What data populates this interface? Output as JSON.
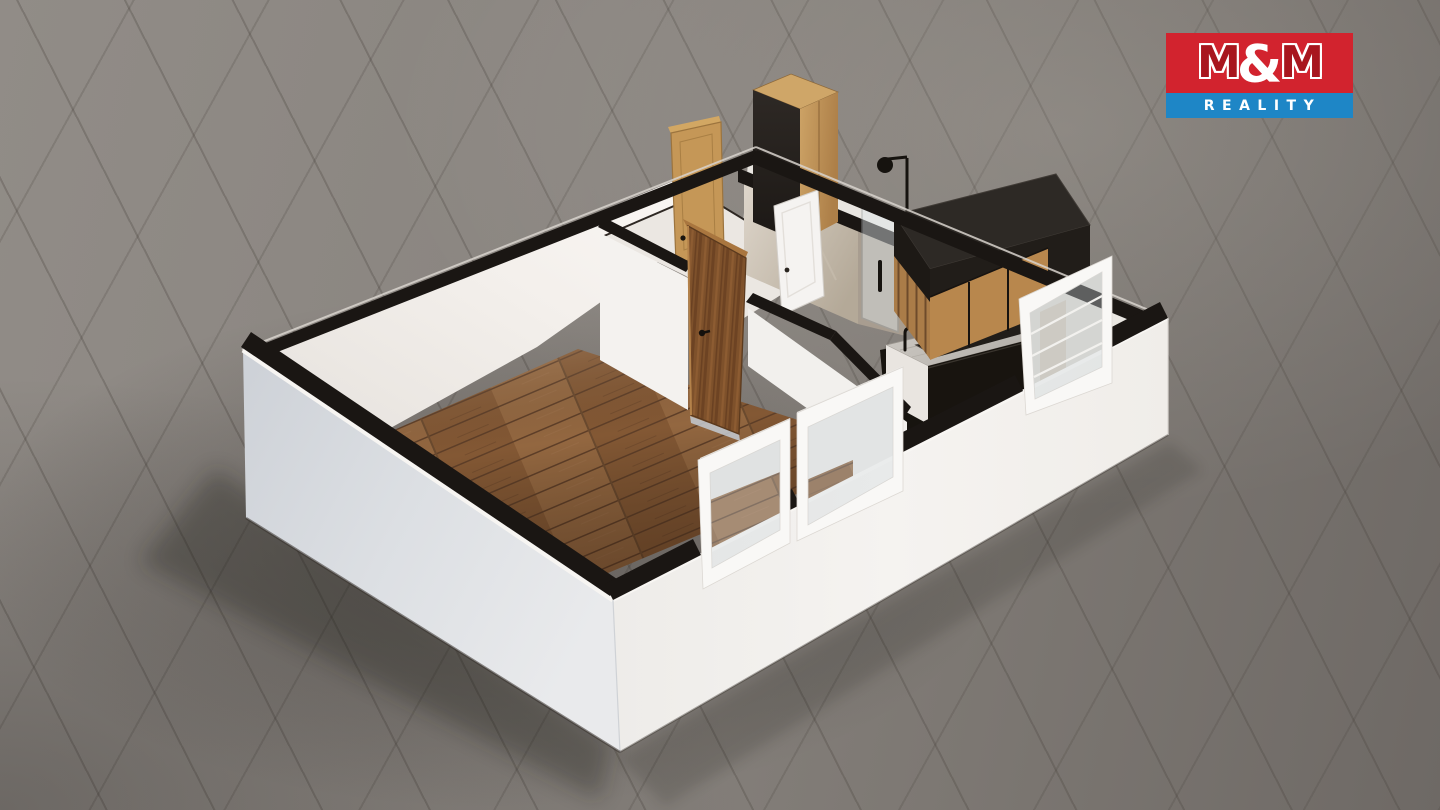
{
  "logo": {
    "m1": "M",
    "amp": "&",
    "m2": "M",
    "subtitle": "REALITY"
  },
  "palette": {
    "brand-red": "#d2232e",
    "brand-red-dark": "#a8161e",
    "brand-blue": "#1e86c6",
    "logo-white": "#ffffff",
    "ground": "#85807b",
    "wall-white": "#f4f2ef",
    "wall-shadow": "#d3d7dc",
    "wall-top": "#1a1613",
    "wood-floor": "#8b5f3b",
    "door-oak": "#c59757",
    "door-walnut": "#7e512b",
    "cabinet-black": "#211d19",
    "cabinet-wood": "#b8874d",
    "counter": "#c2bdb7",
    "marble": "#cfc7bc",
    "glass": "#cdd8de",
    "window-frame": "#f9f8f6"
  }
}
